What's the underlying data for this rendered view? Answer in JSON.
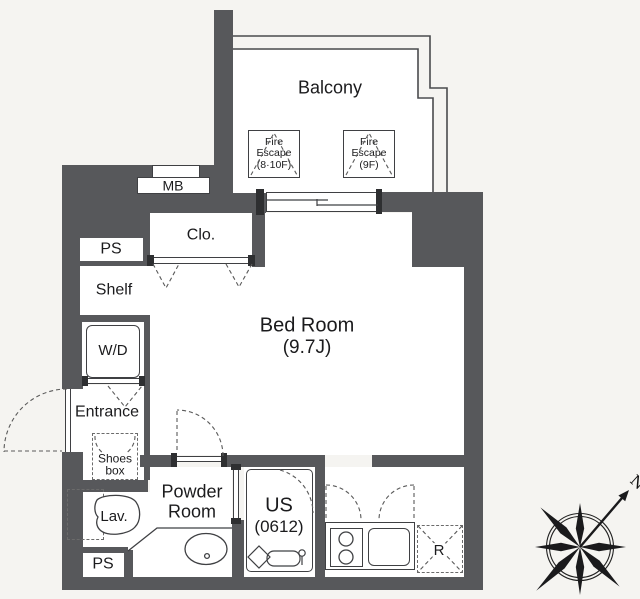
{
  "colors": {
    "wall": "#57585b",
    "line": "#3f4043",
    "dash": "#5a5a5a",
    "background": "#f5f4f1",
    "floor": "#ffffff",
    "text": "#1b1b1d"
  },
  "rooms": {
    "balcony": "Balcony",
    "bedroom_name": "Bed Room",
    "bedroom_size": "(9.7J)",
    "entrance": "Entrance",
    "powder_line1": "Powder",
    "powder_line2": "Room"
  },
  "fixtures": {
    "meter_box": "MB",
    "closet": "Clo.",
    "pipe_space_upper": "PS",
    "shelf": "Shelf",
    "washer_dryer": "W/D",
    "shoes_line1": "Shoes",
    "shoes_line2": "box",
    "lavatory": "Lav.",
    "pipe_space_lower": "PS",
    "unit_bath_line1": "US",
    "unit_bath_line2": "(0612)",
    "refrigerator": "R"
  },
  "fire_escapes": [
    {
      "line1": "Fire",
      "line2": "Escape",
      "line3": "(8·10F)"
    },
    {
      "line1": "Fire",
      "line2": "Escape",
      "line3": "(9F)"
    }
  ],
  "compass": {
    "north": "N"
  }
}
